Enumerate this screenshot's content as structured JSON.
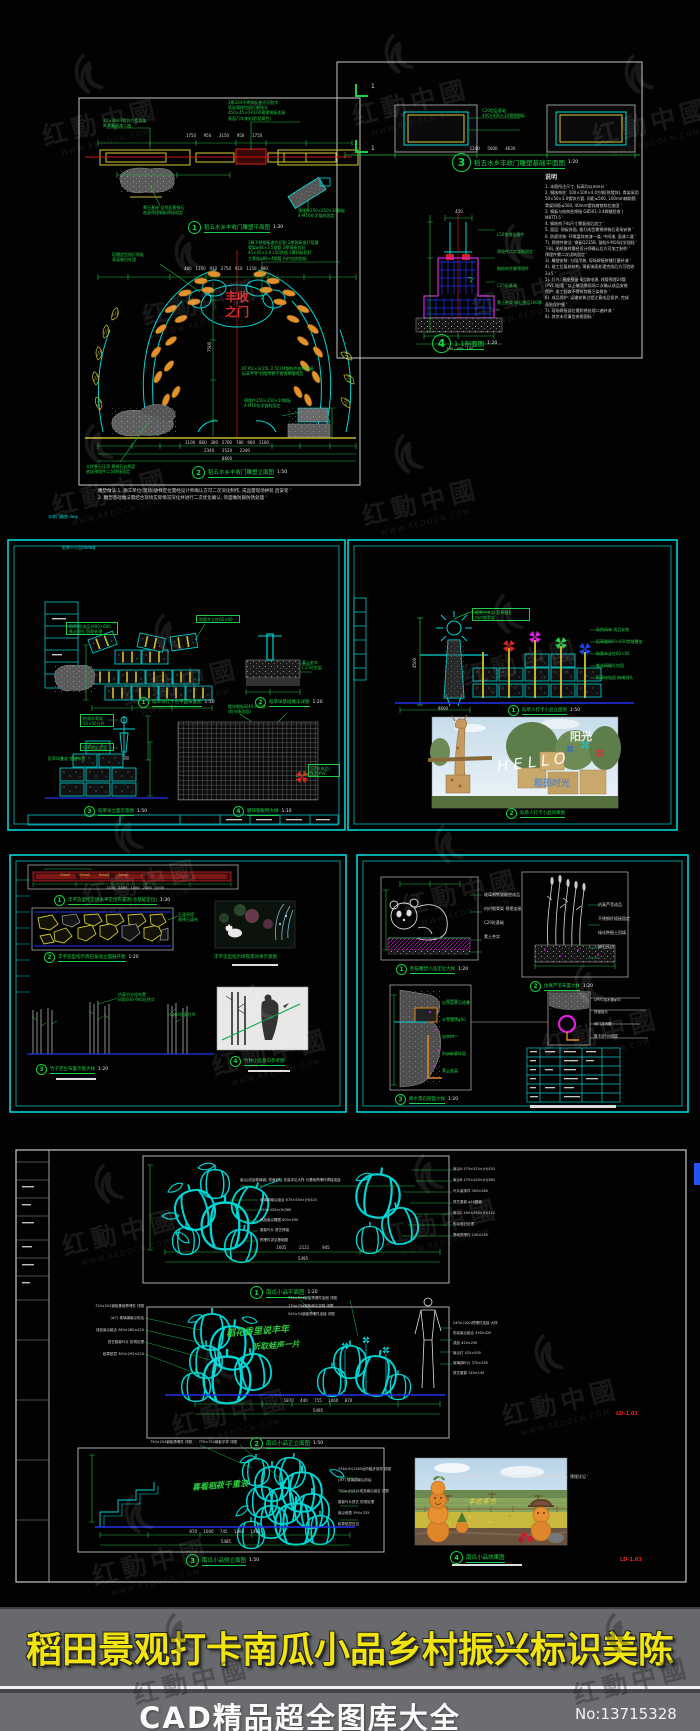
{
  "watermark": {
    "cn": "红動中國",
    "url": "WWW.REDOCN.COM"
  },
  "banner": {
    "title": "稻田景观打卡南瓜小品乡村振兴标识美陈",
    "subtitle": "CAD精品超全图库大全",
    "number": "No:13715328",
    "title_color": "#f2e40e",
    "band_color": "#67696c"
  },
  "sheet1": {
    "file_tag": "丰收门雕塑.dwg",
    "section_mark": "1",
    "beam_label_left": "30×30×3镀锌方管骨架\n外罩氟碳漆二遍",
    "beam_label_right": "3厚304不锈钢板激光切割字\n背部满焊加固打磨抛光\n450×45×(H)100预埋钢板连接\n表面汽车漆处理(稻黄色)",
    "beam_dims": "1750      950      3150      950      1750",
    "stone_label": "景石基座 自然面黄锈石\n底部预埋钢板焊接固定",
    "tilt_label": "预埋件250×250×10钢板\n4-M16化学锚栓固定",
    "fig1": {
      "num": "1",
      "title": "稻五水乡丰收门雕塑平面图",
      "scale": "1:30"
    },
    "arch_top_left": "稻穗造型锻打铜板\n表面做旧处理",
    "arch_top_right": "3厚不锈钢板激光切割 2厚铜板锻打稻穗\n骨架φ48×3.5钢管 2厚铜板包封\n45×45×3.0 L50角钢 2厚铜板稻秆\n主骨架φ89×4钢管 内衬加劲肋板",
    "arch_text": "丰收\n之门",
    "arch_mid_label": "KT.95/×3c25L 2.5CO4钢构件安装连接\n标高平齐 分段吊装于现场焊接成品",
    "pedestal_label": "预埋件250×250×10钢板\n4-M16化学锚栓固定",
    "arch_vdim": "7500",
    "arch_hdim_top": "480   1150   910   2750   910   1150   480",
    "arch_dims_b1": "1100   860   380   2760   780   960   1100",
    "arch_dims_b2": "2340      3520      2340",
    "arch_dims_b3": "8600",
    "arch_bl_label": "大样景石压顶 黄锈石自然面\n底部预埋件二次焊接固定",
    "fig2": {
      "num": "2",
      "title": "稻五水乡丰收门雕塑立面图",
      "scale": "1:50"
    },
    "bottom_note": "雕塑做法:1. 施工单位(现场)放样定位需经设计师确认方可二次深化制作, 成品需现场拼装 后安装 '\n2. 雕塑基础做法需结合现场实际情况深化并进行二次优化确认, 饰面做防腐防锈处理 '",
    "plan_label_a": "C20垫层基础\n400×400×10预埋钢板",
    "dim_row": "1240      5600      4630",
    "fig3": {
      "num": "3",
      "title": "稻五水乡丰收门雕塑基础平面图",
      "scale": "1:20"
    },
    "sec_dim_top": "450",
    "sec_labels": "L50角钢连接件\n预埋件二次浇筑固定 '\n钢结构柱脚预埋件\nC25砼基础\n素土夯实 碎石垫层100厚",
    "sec_dims_bottom": "150   450   150",
    "fig4": {
      "num": "4",
      "title": "1-1剖面图",
      "scale": "1:20"
    },
    "notes_title": "说明",
    "notes": "1. 本图所注尺寸, 标高均以mm计 '\n2. 钢结构柱: 100×100×4.0方钢(热镀锌), 骨架采用\n50×50×3.0镀锌方管, 间距≤500, 100mm辅助筋\n骨架间距≤500, 40mm镀锌扁铁斜拉加固 '\n3. 钢板与结构柱焊接 GB501-3.4焊缝验收 (\nM8TTI-5 '\n4. 钢结构下料尺寸需复核后加工 '\n5. 面层: 铜板饰面, 锻打成型需预拼装后现场安装 '\n6. 防腐涂装: 环氧富锌底漆一道, 中间漆, 面漆二道 '\n7). 预埋件做法: 钢板Q235B, 锚栓4-M16化学锚栓 '\n下料, 图纸放样需经设计师确认后方可加工制作 '\n预埋件需二次浇筑固定 '\n3). 雕塑安装: 分段吊装, 现场焊接拼缝打磨补漆 '\n4). 竣工后复核结构, 铜板饰面处理完成后方可验收\n3±5 '\n5). 灯光: 基座预留-4回路电源, 线管预埋24管\n(PVC)配管 ' 以上做法需现场二次确认成品安装\n保护, 竣工验收不得有划痕污染损伤 '\n6). 成品保护: 运输安装过程注意成品保护, 完成\n面贴保护膜 '\n7). 现场焊接部位需防锈处理二遍补漆 '\n8). 其余未尽事宜参照国标 '"
  },
  "sheet2": {
    "file_tag": "稻草人小品08dwg",
    "plan_label": "稻草捆(成品)900×600\n铁丝捆扎 防腐处理",
    "plan_label2": "防腐木立柱60×60",
    "grid_label": "镀锌钢板网40×40目\n(防鸟啄加固)",
    "found_label": "素土夯实\nC15砼垫层",
    "scare_label1": "防腐木骨架\n50×50立杆",
    "scare_label2": "稻草捆扎造型",
    "stack_label": "稻草垛叠放 错缝布置",
    "pin_label": "风车(成品)\n彩色PVC",
    "fig1": {
      "num": "1",
      "title": "稻草垛打卡点平面布置图",
      "scale": "1:50"
    },
    "fig2": {
      "num": "2",
      "title": "稻草垛基础做法详图",
      "scale": "1:20"
    },
    "fig3": {
      "num": "3",
      "title": "稻草垛立面示意图",
      "scale": "1:50"
    },
    "fig4": {
      "num": "4",
      "title": "镀锌钢板网大样",
      "scale": "1:10"
    },
    "elev_top_label": "稻草人头部 稻草捆扎\n内衬钢骨架",
    "elev_right_labels": "彩色风车 成品安装\n稻草捆900×600错缝叠放\n防腐木立柱60×60\n铁丝网捆扎加固\n稻草帘包面 麻绳绑扎",
    "elev_dim": "4500",
    "ground_dim": "9600",
    "fig5": {
      "num": "1",
      "title": "稻草人打卡小品立面图",
      "scale": "1:50"
    },
    "photo_hello": "HELLO",
    "photo_sun": "阳光",
    "photo_time": "稻田时光",
    "fig6": {
      "num": "2",
      "title": "稻草人打卡小品效果图",
      "scale": ""
    }
  },
  "sheet3": {
    "sign_band_labels": "Gma2        Gma2        Gma2        Gma2",
    "sign_dims": "1200   2400   1200   2400   1200",
    "fig1": {
      "num": "1",
      "title": "丰字造型指示牌水平定位布置图(含基础定位)",
      "scale": "1:30"
    },
    "wall_label": "石笼网墙\n黄锈石填充",
    "fig2": {
      "num": "2",
      "title": "丰字造型指示牌石笼墙立面展开图",
      "scale": "1:20"
    },
    "photo_title": "丰字造型指示牌夜景效果示意图",
    "bamboo_label1": "仿真竹分组布置\n间距600-900自然式",
    "bamboo_label2": "φ60仿真竹竿",
    "fig3": {
      "num": "3",
      "title": "竹子定位布置示意大样",
      "scale": "1:20"
    },
    "fig4": {
      "num": "4",
      "title": "竹林小品意向参考图",
      "scale": ""
    },
    "panda_labels": "玻璃钢熊猫雕塑成品\n内衬钢骨架 预埋连接\nC20砼基础\n素土夯实",
    "fig5": {
      "num": "1",
      "title": "熊猫雕塑小品定位大样",
      "scale": "1:20"
    },
    "reed_labels": "仿真芦苇成品\n不锈钢杆插接固定\n绿化种植土回填\n碎石压边",
    "fig6": {
      "num": "2",
      "title": "仿真芦苇布置大样",
      "scale": "1:20"
    },
    "fall_labels": "自然面景石堆叠\n水泵管线φ50\n溢水口\n防水砂浆抹面\n素土夯实",
    "fig7": {
      "num": "3",
      "title": "跌水景石剖面大样",
      "scale": "1:20"
    },
    "pipe_labels": "UPVC给水管φ50\n快速接头\n阀门井内置\n管卡@500固定"
  },
  "sheet4": {
    "p1_top_label": "南瓜(成品玻璃钢) 表面彩绘 安装详见大样 与基础预埋件焊接连接",
    "p1_center_labels": "玻璃钢南瓜组合 675×550×(H)520\n450×420×(H)360\n成品南瓜雕塑 600×550\n藤蔓叶片 铁艺焊接\n预埋件详见基础图",
    "p1_right_labels": "南瓜A 575×525×(H)420\n南瓜B 475×420×(H)360\n叶片装饰件 300×280\n铁艺藤蔓 φ16圆钢\n南瓜C 450×390×(H)310\n彩绘做旧处理\n基础预埋件 240×240",
    "p1_dims": "1605          2121          945",
    "p1_total": "5495",
    "fig1": {
      "num": "1",
      "title": "南瓜小品平面图",
      "scale": "1:20"
    },
    "p2_left_labels": "720×524钢板基础预埋件 详图\n(#7) 玻璃钢南瓜彩绘\n成品南瓜组合 360×280×420\n铁艺藤蔓叶片 防锈处理\n稻草垫层 300×295×220",
    "p2_top_labels": "750×514钢板预埋件加固 详图\n770×754钢板南瓜字样 详图\n545×54钢板预埋件连接 详图",
    "p2_right_labels": "240×(100)预埋件连接 大样\n彩绘南瓜组合 430×420\n成品 420×250\n南瓜灯 425×500\n玻璃钢叶片 370×295\n铁艺藤蔓 140×145",
    "p2_script1": "稻花香里说丰年",
    "p2_script2": "听取蛙声一片",
    "p2_dims": "1870     440     755     1060     870",
    "p2_total": "5495",
    "fig2": {
      "num": "2",
      "title": "南瓜小品正立面图",
      "scale": "1:50"
    },
    "note": "说明：图中小品尺寸仅为参考，以厂家二次深化设计及现场放样定制为准，预埋详见 '",
    "sheet_no": "LD-1.03",
    "p3_top_labels": "750×254钢板预埋件 详图      770×754钢板字样 详图",
    "p3_right_labels": "336×(H)1260台阶踏步放样 详图\n(#7) 玻璃钢南瓜彩绘\n750×(H)524成品南瓜组合 详图\n藤蔓叶片铁艺 防锈处理\n南瓜堆叠 390×325\n稻草垫层压边",
    "p3_script": "喜看稻菽千重浪",
    "p3_dims": "870     1000     745     1460     1405",
    "p3_total": "5485",
    "fig3": {
      "num": "3",
      "title": "南瓜小品侧立面图",
      "scale": "1:50"
    },
    "photo_script": "丰收季节",
    "fig4": {
      "num": "4",
      "title": "南瓜小品效果图",
      "scale": ""
    }
  }
}
